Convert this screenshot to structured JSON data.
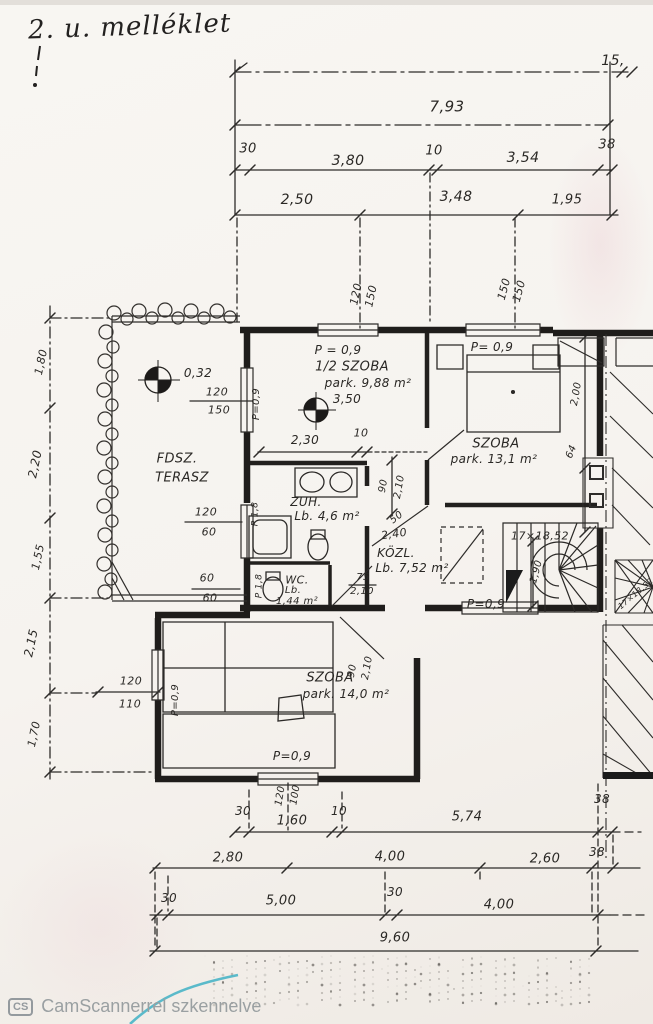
{
  "page": {
    "title": "2. u. melléklet",
    "footer": {
      "badge": "CS",
      "text": "CamScannerrel szkennelve"
    }
  },
  "colors": {
    "ink": "#2e2c2a",
    "watermark": "#9aa0a2",
    "teal_edge": "#3fb0c4",
    "paper": "#f6f3ef"
  },
  "rooms": [
    {
      "name": "FDSZ. TERASZ"
    },
    {
      "name": "1/2 SZOBA",
      "area": "park. 9,88 m²"
    },
    {
      "name": "SZOBA",
      "area": "park. 13,1 m²"
    },
    {
      "name": "ZUH.",
      "area": "Lb. 4,6 m²"
    },
    {
      "name": "WC.",
      "area": "Lb. 1,44 m²"
    },
    {
      "name": "KÖZL.",
      "area": "Lb. 7,52 m²"
    },
    {
      "name": "SZOBA",
      "area": "park. 14,0 m²"
    }
  ],
  "labels": [
    {
      "id": "page-num",
      "t": "15,",
      "x": 613,
      "y": 61,
      "s": 14
    },
    {
      "id": "dim-793",
      "t": "7,93",
      "x": 447,
      "y": 107,
      "s": 15
    },
    {
      "id": "dim-30a",
      "t": "30",
      "x": 248,
      "y": 149,
      "s": 13
    },
    {
      "id": "dim-380",
      "t": "3,80",
      "x": 348,
      "y": 161,
      "s": 14
    },
    {
      "id": "dim-10a",
      "t": "10",
      "x": 434,
      "y": 151,
      "s": 13
    },
    {
      "id": "dim-354",
      "t": "3,54",
      "x": 523,
      "y": 158,
      "s": 14
    },
    {
      "id": "dim-38a",
      "t": "38",
      "x": 607,
      "y": 145,
      "s": 13
    },
    {
      "id": "dim-250",
      "t": "2,50",
      "x": 297,
      "y": 200,
      "s": 14
    },
    {
      "id": "dim-348",
      "t": "3,48",
      "x": 456,
      "y": 197,
      "s": 14
    },
    {
      "id": "dim-195",
      "t": "1,95",
      "x": 567,
      "y": 200,
      "s": 13
    },
    {
      "id": "dim-v120a",
      "t": "120",
      "x": 356,
      "y": 294,
      "r": -78,
      "s": 11
    },
    {
      "id": "dim-v150a",
      "t": "150",
      "x": 371,
      "y": 296,
      "r": -78,
      "s": 11
    },
    {
      "id": "dim-v150b",
      "t": "150",
      "x": 504,
      "y": 289,
      "r": -75,
      "s": 11
    },
    {
      "id": "dim-v150c",
      "t": "150",
      "x": 519,
      "y": 291,
      "r": -75,
      "s": 11
    },
    {
      "id": "dim-l180",
      "t": "1,80",
      "x": 41,
      "y": 362,
      "r": -78,
      "s": 11
    },
    {
      "id": "dim-l220",
      "t": "2,20",
      "x": 35,
      "y": 464,
      "r": -78,
      "s": 12
    },
    {
      "id": "dim-l155",
      "t": "1,55",
      "x": 38,
      "y": 557,
      "r": -78,
      "s": 11
    },
    {
      "id": "dim-l215",
      "t": "2,15",
      "x": 31,
      "y": 643,
      "r": -78,
      "s": 12
    },
    {
      "id": "dim-l170",
      "t": "1,70",
      "x": 34,
      "y": 734,
      "r": -78,
      "s": 11
    },
    {
      "id": "survey-032",
      "t": "0,32",
      "x": 198,
      "y": 373,
      "s": 12
    },
    {
      "id": "fr-120a",
      "t": "120",
      "x": 217,
      "y": 392,
      "s": 11
    },
    {
      "id": "fr-150a",
      "t": "150",
      "x": 219,
      "y": 410,
      "s": 11
    },
    {
      "id": "room-fdsz",
      "t": "FDSZ.",
      "x": 177,
      "y": 459,
      "s": 13
    },
    {
      "id": "room-terasz",
      "t": "TERASZ",
      "x": 182,
      "y": 478,
      "s": 13
    },
    {
      "id": "fr-120b",
      "t": "120",
      "x": 206,
      "y": 512,
      "s": 11
    },
    {
      "id": "fr-60a",
      "t": "60",
      "x": 209,
      "y": 532,
      "s": 11
    },
    {
      "id": "fr-60b",
      "t": "60",
      "x": 207,
      "y": 578,
      "s": 11
    },
    {
      "id": "fr-60c",
      "t": "60",
      "x": 210,
      "y": 598,
      "s": 11
    },
    {
      "id": "r1-ptop",
      "t": "P = 0,9",
      "x": 338,
      "y": 350,
      "s": 12
    },
    {
      "id": "r1-pleft",
      "t": "P=0,9",
      "x": 257,
      "y": 404,
      "r": -90,
      "s": 10
    },
    {
      "id": "r1-name",
      "t": "1/2 SZOBA",
      "x": 352,
      "y": 367,
      "s": 13
    },
    {
      "id": "r1-area",
      "t": "park. 9,88 m²",
      "x": 368,
      "y": 383,
      "s": 12
    },
    {
      "id": "r1-350",
      "t": "3,50",
      "x": 347,
      "y": 399,
      "s": 12
    },
    {
      "id": "r1-230",
      "t": "2,30",
      "x": 305,
      "y": 440,
      "s": 12
    },
    {
      "id": "r1-10",
      "t": "10",
      "x": 361,
      "y": 433,
      "s": 11
    },
    {
      "id": "r2-ptop",
      "t": "P= 0,9",
      "x": 492,
      "y": 347,
      "s": 12
    },
    {
      "id": "r2-name",
      "t": "SZOBA",
      "x": 496,
      "y": 444,
      "s": 13
    },
    {
      "id": "r2-area",
      "t": "park. 13,1 m²",
      "x": 494,
      "y": 459,
      "s": 12
    },
    {
      "id": "r2-200",
      "t": "2,00",
      "x": 577,
      "y": 394,
      "r": -80,
      "s": 10
    },
    {
      "id": "r2-64",
      "t": "64",
      "x": 572,
      "y": 452,
      "r": -68,
      "s": 10
    },
    {
      "id": "zuh-name",
      "t": "ZUH.",
      "x": 306,
      "y": 502,
      "s": 12
    },
    {
      "id": "zuh-area",
      "t": "Lb. 4,6 m²",
      "x": 327,
      "y": 516,
      "s": 12
    },
    {
      "id": "zuh-p18",
      "t": "P 1,8",
      "x": 256,
      "y": 514,
      "r": -90,
      "s": 9
    },
    {
      "id": "wc-p18",
      "t": "P 1,8",
      "x": 260,
      "y": 586,
      "r": -90,
      "s": 9
    },
    {
      "id": "wc-name",
      "t": "WC.",
      "x": 297,
      "y": 580,
      "s": 11
    },
    {
      "id": "wc-lb",
      "t": "Lb.",
      "x": 293,
      "y": 591,
      "s": 10
    },
    {
      "id": "wc-area",
      "t": "1,44 m²",
      "x": 297,
      "y": 602,
      "s": 10
    },
    {
      "id": "wc-75",
      "t": "75",
      "x": 363,
      "y": 578,
      "s": 10
    },
    {
      "id": "wc-210",
      "t": "2,10",
      "x": 362,
      "y": 592,
      "s": 10
    },
    {
      "id": "k-90",
      "t": "90",
      "x": 384,
      "y": 486,
      "r": -80,
      "s": 10
    },
    {
      "id": "k-210",
      "t": "2,10",
      "x": 400,
      "y": 487,
      "r": -80,
      "s": 10
    },
    {
      "id": "k-50",
      "t": "50",
      "x": 397,
      "y": 518,
      "r": -38,
      "s": 10
    },
    {
      "id": "k-240",
      "t": "2,40",
      "x": 394,
      "y": 534,
      "r": -8,
      "s": 11
    },
    {
      "id": "k-name",
      "t": "KÖZL.",
      "x": 396,
      "y": 553,
      "s": 12
    },
    {
      "id": "k-area",
      "t": "Lb. 7,52 m²",
      "x": 412,
      "y": 568,
      "s": 12
    },
    {
      "id": "st-label",
      "t": "17×18,52",
      "x": 540,
      "y": 536,
      "s": 11
    },
    {
      "id": "st-190",
      "t": "1,90",
      "x": 537,
      "y": 572,
      "r": -75,
      "s": 10
    },
    {
      "id": "st-p09",
      "t": "P=0,9",
      "x": 486,
      "y": 604,
      "s": 12
    },
    {
      "id": "st2-label",
      "t": "17×18,52",
      "x": 636,
      "y": 594,
      "r": -40,
      "s": 8
    },
    {
      "id": "br-name",
      "t": "SZOBA",
      "x": 330,
      "y": 678,
      "s": 13
    },
    {
      "id": "br-area",
      "t": "park. 14,0 m²",
      "x": 346,
      "y": 694,
      "s": 12
    },
    {
      "id": "br-90",
      "t": "90",
      "x": 353,
      "y": 671,
      "r": -80,
      "s": 10
    },
    {
      "id": "br-210",
      "t": "2,10",
      "x": 368,
      "y": 668,
      "r": -80,
      "s": 10
    },
    {
      "id": "br-pleft",
      "t": "P=0,9",
      "x": 176,
      "y": 700,
      "r": -90,
      "s": 10
    },
    {
      "id": "br-pbottom",
      "t": "P=0,9",
      "x": 292,
      "y": 756,
      "s": 12
    },
    {
      "id": "br-120",
      "t": "120",
      "x": 281,
      "y": 796,
      "r": -80,
      "s": 10
    },
    {
      "id": "br-100",
      "t": "100",
      "x": 296,
      "y": 795,
      "r": -80,
      "s": 10
    },
    {
      "id": "bl-120",
      "t": "120",
      "x": 131,
      "y": 681,
      "s": 11
    },
    {
      "id": "bl-110",
      "t": "110",
      "x": 130,
      "y": 704,
      "s": 11
    },
    {
      "id": "ba-30",
      "t": "30",
      "x": 243,
      "y": 811,
      "s": 12
    },
    {
      "id": "ba-160",
      "t": "1,60",
      "x": 292,
      "y": 821,
      "s": 13
    },
    {
      "id": "ba-10",
      "t": "10",
      "x": 339,
      "y": 811,
      "s": 12
    },
    {
      "id": "ba-574",
      "t": "5,74",
      "x": 467,
      "y": 817,
      "s": 13
    },
    {
      "id": "ba-38",
      "t": "38",
      "x": 602,
      "y": 799,
      "s": 12
    },
    {
      "id": "bb-280",
      "t": "2,80",
      "x": 228,
      "y": 858,
      "s": 13
    },
    {
      "id": "bb-400",
      "t": "4,00",
      "x": 390,
      "y": 857,
      "s": 13
    },
    {
      "id": "bb-260",
      "t": "2,60",
      "x": 545,
      "y": 859,
      "s": 13
    },
    {
      "id": "bb-38",
      "t": "38",
      "x": 597,
      "y": 852,
      "s": 12
    },
    {
      "id": "bc-30a",
      "t": "30",
      "x": 169,
      "y": 898,
      "s": 12
    },
    {
      "id": "bc-500",
      "t": "5,00",
      "x": 281,
      "y": 901,
      "s": 13
    },
    {
      "id": "bc-30b",
      "t": "30",
      "x": 395,
      "y": 892,
      "s": 12
    },
    {
      "id": "bc-400",
      "t": "4,00",
      "x": 499,
      "y": 905,
      "s": 13
    },
    {
      "id": "bd-960",
      "t": "9,60",
      "x": 395,
      "y": 938,
      "s": 13
    }
  ]
}
